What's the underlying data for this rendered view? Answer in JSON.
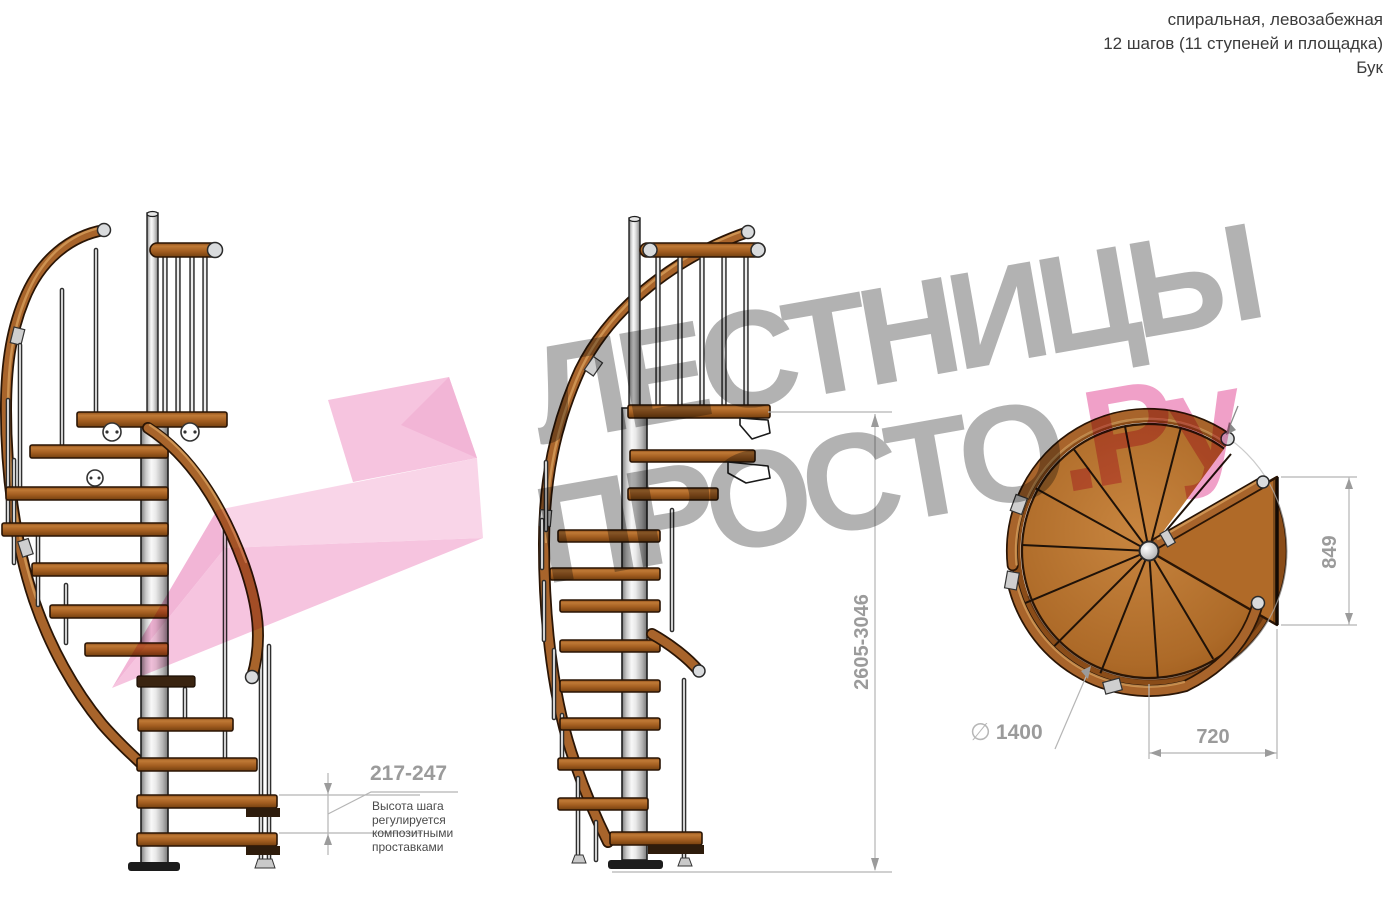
{
  "header": {
    "line1": "спиральная, левозабежная",
    "line2": "12 шагов (11 ступеней и площадка)",
    "line3": "Бук"
  },
  "watermark": {
    "word1": "ЛЕСТНИЦЫ",
    "word2": "ПРОСТО",
    "suffix": ".Ру"
  },
  "dimensions": {
    "total_height": "2605-3046",
    "step_height": "217-247",
    "platform_depth": "849",
    "platform_length": "720",
    "diameter_symbol": "∅",
    "diameter": "1400"
  },
  "note_lines": [
    "Высота шага",
    "регулируется",
    "композитными",
    "проставками"
  ],
  "colors": {
    "wood_main": "#a8642b",
    "wood_light": "#d49a58",
    "wood_dark": "#74400f",
    "outline": "#2a1505",
    "metal_light": "#f5f5f5",
    "metal_dark": "#8f8f8f",
    "dim_text": "#9b9b9b",
    "dim_line": "#b5b5b5",
    "note_text": "#4a4a4a",
    "watermark_gray": "#b2b2b2",
    "watermark_pink": "#f0a0c8",
    "logo_pink_light": "#f8cbe3",
    "logo_pink_mid": "#f4b5d7",
    "logo_pink_dark": "#efa2cc"
  }
}
